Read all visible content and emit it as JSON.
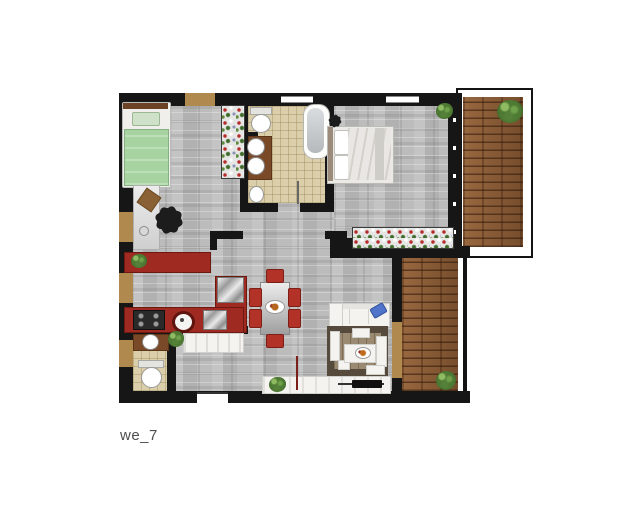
{
  "caption": "we_7",
  "palette": {
    "background": "#ffffff",
    "wall": "#161616",
    "stone_floor": "#b9b9b9",
    "tile_floor": "#dbcfab",
    "deck_wood": "#8a5a34",
    "kitchen_red": "#9e2a22",
    "chair_red": "#b23227",
    "bed_green": "#a6d3a0",
    "sofa_white": "#f4f3ef",
    "rug_brown": "#564a3c",
    "rug_inner": "#9b8a72",
    "accent_blue": "#4f74c9",
    "plant_green": "#4e7a33",
    "door_tan": "#b0894e",
    "vanity_brown": "#7a4a28"
  },
  "objects": [
    "single-bed",
    "desk",
    "office-chair",
    "desk-lamp",
    "flower-shelf",
    "toilet",
    "double-sink-vanity",
    "bathtub",
    "pedestal-sink",
    "double-bed",
    "bedside-vase",
    "corner-plant",
    "window-flower-box",
    "kitchen-sideboard",
    "sideboard-plant",
    "kitchen-counter",
    "corner-fridge",
    "cooktop",
    "kitchen-sink",
    "dishwasher",
    "wc-sink-vanity",
    "wc-toilet",
    "storage-bench",
    "bench-plant",
    "dining-table",
    "dining-chair-x6",
    "dinner-plate",
    "sofa",
    "blue-pillow",
    "rug",
    "floor-cushions",
    "coffee-table",
    "tv-sideboard",
    "tv",
    "sideboard-plant-2",
    "radiator-mark",
    "upper-terrace-deck",
    "upper-terrace-bush",
    "lower-terrace-deck",
    "lower-terrace-plant"
  ],
  "counts": {
    "dining_chairs": 6,
    "terraces": 2,
    "bathrooms": 2,
    "bedrooms": 2
  }
}
